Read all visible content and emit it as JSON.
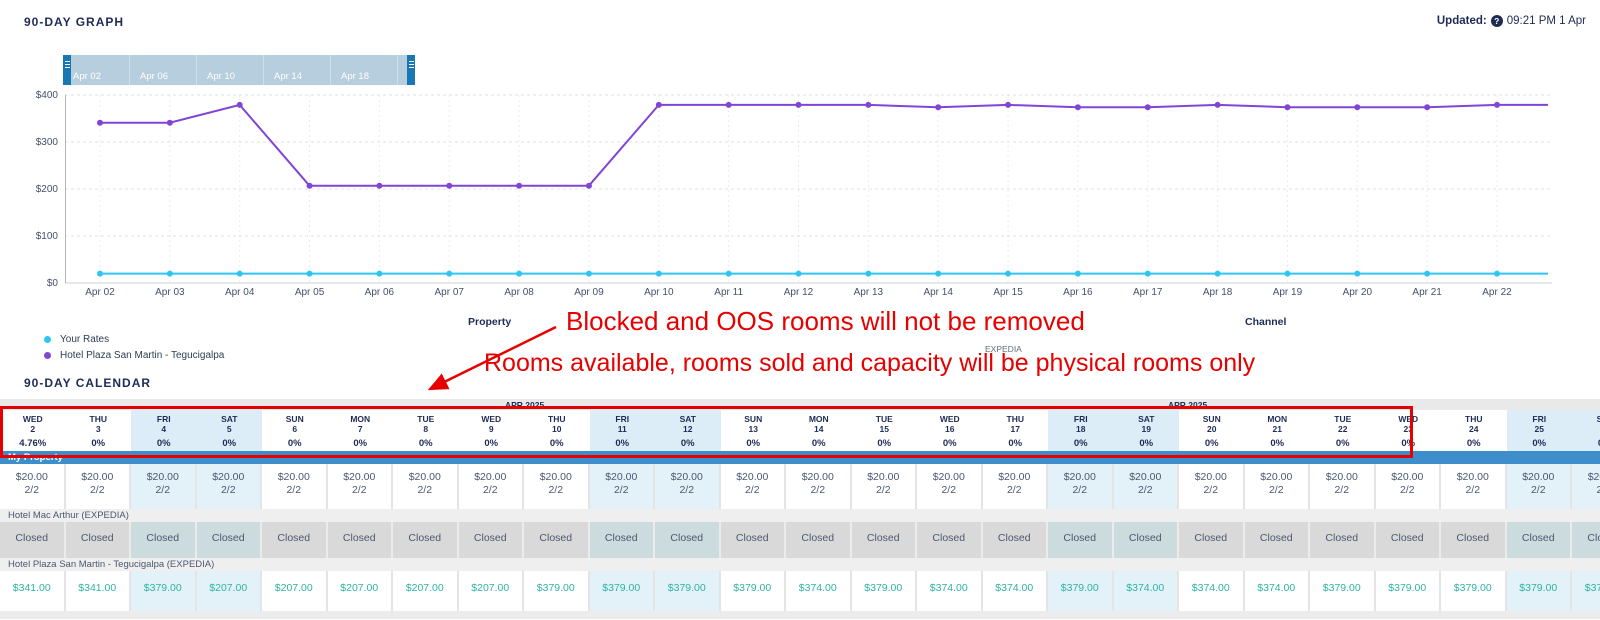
{
  "graph_section": {
    "title": "90-DAY GRAPH",
    "updated_label": "Updated:",
    "updated_help_icon": "question-mark-circle-icon",
    "updated_time": "09:21 PM 1 Apr",
    "slider": {
      "labels": [
        "Apr 02",
        "Apr 06",
        "Apr 10",
        "Apr 14",
        "Apr 18",
        "Ap"
      ]
    },
    "legend": [
      {
        "label": "Your Rates",
        "color": "#2fc5f2"
      },
      {
        "label": "Hotel Plaza San Martin - Tegucigalpa",
        "color": "#8145d6"
      }
    ]
  },
  "chart_data": {
    "type": "line",
    "x_labels": [
      "Apr 02",
      "Apr 03",
      "Apr 04",
      "Apr 05",
      "Apr 06",
      "Apr 07",
      "Apr 08",
      "Apr 09",
      "Apr 10",
      "Apr 11",
      "Apr 12",
      "Apr 13",
      "Apr 14",
      "Apr 15",
      "Apr 16",
      "Apr 17",
      "Apr 18",
      "Apr 19",
      "Apr 20",
      "Apr 21",
      "Apr 22"
    ],
    "ylim": [
      0,
      400
    ],
    "yticks": [
      0,
      100,
      200,
      300,
      400
    ],
    "ytick_labels": [
      "$0",
      "$100",
      "$200",
      "$300",
      "$400"
    ],
    "grid": true,
    "legend_position": "bottom-left",
    "series": [
      {
        "name": "Your Rates",
        "color": "#2fc5f2",
        "values": [
          20,
          20,
          20,
          20,
          20,
          20,
          20,
          20,
          20,
          20,
          20,
          20,
          20,
          20,
          20,
          20,
          20,
          20,
          20,
          20,
          20
        ]
      },
      {
        "name": "Hotel Plaza San Martin - Tegucigalpa",
        "color": "#8145d6",
        "values": [
          341,
          341,
          379,
          207,
          207,
          207,
          207,
          207,
          379,
          379,
          379,
          379,
          374,
          379,
          374,
          374,
          379,
          374,
          374,
          374,
          379
        ]
      }
    ]
  },
  "filters": {
    "property_label": "Property",
    "channel_label": "Channel",
    "channel_value": "EXPEDIA"
  },
  "annotations": {
    "line1": "Blocked and OOS rooms will not be removed",
    "line2": "Rooms available, rooms sold and capacity will be physical rooms only",
    "color": "#e60100"
  },
  "calendar_section": {
    "title": "90-DAY CALENDAR",
    "month_labels": [
      "APR 2025",
      "APR 2025"
    ],
    "days": [
      {
        "dow": "WED",
        "date": "2",
        "occ": "4.76%",
        "weekend": false
      },
      {
        "dow": "THU",
        "date": "3",
        "occ": "0%",
        "weekend": false
      },
      {
        "dow": "FRI",
        "date": "4",
        "occ": "0%",
        "weekend": true
      },
      {
        "dow": "SAT",
        "date": "5",
        "occ": "0%",
        "weekend": true
      },
      {
        "dow": "SUN",
        "date": "6",
        "occ": "0%",
        "weekend": false
      },
      {
        "dow": "MON",
        "date": "7",
        "occ": "0%",
        "weekend": false
      },
      {
        "dow": "TUE",
        "date": "8",
        "occ": "0%",
        "weekend": false
      },
      {
        "dow": "WED",
        "date": "9",
        "occ": "0%",
        "weekend": false
      },
      {
        "dow": "THU",
        "date": "10",
        "occ": "0%",
        "weekend": false
      },
      {
        "dow": "FRI",
        "date": "11",
        "occ": "0%",
        "weekend": true
      },
      {
        "dow": "SAT",
        "date": "12",
        "occ": "0%",
        "weekend": true
      },
      {
        "dow": "SUN",
        "date": "13",
        "occ": "0%",
        "weekend": false
      },
      {
        "dow": "MON",
        "date": "14",
        "occ": "0%",
        "weekend": false
      },
      {
        "dow": "TUE",
        "date": "15",
        "occ": "0%",
        "weekend": false
      },
      {
        "dow": "WED",
        "date": "16",
        "occ": "0%",
        "weekend": false
      },
      {
        "dow": "THU",
        "date": "17",
        "occ": "0%",
        "weekend": false
      },
      {
        "dow": "FRI",
        "date": "18",
        "occ": "0%",
        "weekend": true
      },
      {
        "dow": "SAT",
        "date": "19",
        "occ": "0%",
        "weekend": true
      },
      {
        "dow": "SUN",
        "date": "20",
        "occ": "0%",
        "weekend": false
      },
      {
        "dow": "MON",
        "date": "21",
        "occ": "0%",
        "weekend": false
      },
      {
        "dow": "TUE",
        "date": "22",
        "occ": "0%",
        "weekend": false
      },
      {
        "dow": "WED",
        "date": "23",
        "occ": "0%",
        "weekend": false
      },
      {
        "dow": "THU",
        "date": "24",
        "occ": "0%",
        "weekend": false
      },
      {
        "dow": "FRI",
        "date": "25",
        "occ": "0%",
        "weekend": true
      },
      {
        "dow": "SAT",
        "date": "26",
        "occ": "0%",
        "weekend": true
      }
    ],
    "highlight_box_last_day_index": 21,
    "rows": {
      "my_property": {
        "label": "My Property",
        "rates": [
          "$20.00",
          "$20.00",
          "$20.00",
          "$20.00",
          "$20.00",
          "$20.00",
          "$20.00",
          "$20.00",
          "$20.00",
          "$20.00",
          "$20.00",
          "$20.00",
          "$20.00",
          "$20.00",
          "$20.00",
          "$20.00",
          "$20.00",
          "$20.00",
          "$20.00",
          "$20.00",
          "$20.00",
          "$20.00",
          "$20.00",
          "$20.00",
          "$20.00"
        ],
        "inventory": [
          "2/2",
          "2/2",
          "2/2",
          "2/2",
          "2/2",
          "2/2",
          "2/2",
          "2/2",
          "2/2",
          "2/2",
          "2/2",
          "2/2",
          "2/2",
          "2/2",
          "2/2",
          "2/2",
          "2/2",
          "2/2",
          "2/2",
          "2/2",
          "2/2",
          "2/2",
          "2/2",
          "2/2",
          "2/2"
        ]
      },
      "mac_arthur": {
        "label": "Hotel Mac Arthur (EXPEDIA)",
        "cells": [
          "Closed",
          "Closed",
          "Closed",
          "Closed",
          "Closed",
          "Closed",
          "Closed",
          "Closed",
          "Closed",
          "Closed",
          "Closed",
          "Closed",
          "Closed",
          "Closed",
          "Closed",
          "Closed",
          "Closed",
          "Closed",
          "Closed",
          "Closed",
          "Closed",
          "Closed",
          "Closed",
          "Closed",
          "Closed"
        ]
      },
      "plaza": {
        "label": "Hotel Plaza San Martin - Tegucigalpa (EXPEDIA)",
        "cells": [
          "$341.00",
          "$341.00",
          "$379.00",
          "$207.00",
          "$207.00",
          "$207.00",
          "$207.00",
          "$207.00",
          "$379.00",
          "$379.00",
          "$379.00",
          "$379.00",
          "$374.00",
          "$379.00",
          "$374.00",
          "$374.00",
          "$379.00",
          "$374.00",
          "$374.00",
          "$374.00",
          "$379.00",
          "$379.00",
          "$379.00",
          "$379.00",
          "$379.00"
        ]
      }
    }
  }
}
